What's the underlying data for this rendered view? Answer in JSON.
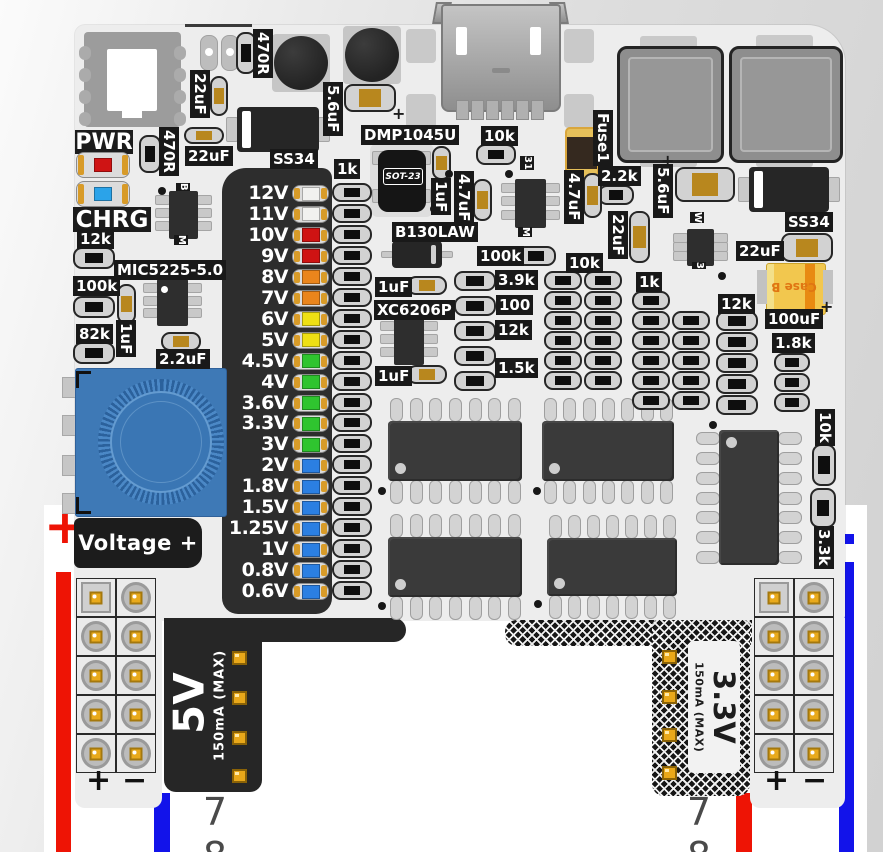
{
  "scene": "breadboard-power-supply-pcb-illustration",
  "breadboard": {
    "row_numbers_left": [
      "7",
      "8"
    ],
    "row_numbers_right": [
      "7",
      "8"
    ],
    "rail_plus": "+",
    "grid_plus": "+",
    "grid_minus": "−",
    "rail_red": "#ee1405",
    "rail_blue": "#1213ea"
  },
  "power_tabs": {
    "left": {
      "title": "5V",
      "subtitle": "150mA (MAX)"
    },
    "right": {
      "title": "3.3V",
      "subtitle": "150mA (MAX)"
    }
  },
  "voltage_selector": {
    "header_label": "Voltage +",
    "resistor_column_label": "1k",
    "rows": [
      {
        "label": "12V",
        "color": "#f1f1ef"
      },
      {
        "label": "11V",
        "color": "#f1f1ef"
      },
      {
        "label": "10V",
        "color": "#cf1313"
      },
      {
        "label": "9V",
        "color": "#cf1313"
      },
      {
        "label": "8V",
        "color": "#ea851c"
      },
      {
        "label": "7V",
        "color": "#ea851c"
      },
      {
        "label": "6V",
        "color": "#eee014"
      },
      {
        "label": "5V",
        "color": "#eee014"
      },
      {
        "label": "4.5V",
        "color": "#2fc42f"
      },
      {
        "label": "4V",
        "color": "#2fc42f"
      },
      {
        "label": "3.6V",
        "color": "#2fc42f"
      },
      {
        "label": "3.3V",
        "color": "#2fc42f"
      },
      {
        "label": "3V",
        "color": "#2fc42f"
      },
      {
        "label": "2V",
        "color": "#2b7fe2"
      },
      {
        "label": "1.8V",
        "color": "#2b7fe2"
      },
      {
        "label": "1.5V",
        "color": "#2b7fe2"
      },
      {
        "label": "1.25V",
        "color": "#2b7fe2"
      },
      {
        "label": "1V",
        "color": "#2b7fe2"
      },
      {
        "label": "0.8V",
        "color": "#2b7fe2"
      },
      {
        "label": "0.6V",
        "color": "#2b7fe2"
      }
    ]
  },
  "status_leds": {
    "pwr": {
      "label": "PWR",
      "color": "#cf1414"
    },
    "chrg": {
      "label": "CHRG",
      "color": "#2ba3e9"
    }
  },
  "chip_markings": {
    "dmp_package": "SOT-23",
    "tantalum_case": "Case B"
  },
  "silkscreen_labels": [
    {
      "text": "470R",
      "x": 253,
      "y": 29,
      "v": 1
    },
    {
      "text": "22uF",
      "x": 190,
      "y": 70,
      "v": 1
    },
    {
      "text": "5.6uF",
      "x": 323,
      "y": 82,
      "v": 1
    },
    {
      "text": "470R",
      "x": 159,
      "y": 127,
      "v": 1
    },
    {
      "text": "22uF",
      "x": 185,
      "y": 146
    },
    {
      "text": "SS34",
      "x": 270,
      "y": 149
    },
    {
      "text": "DMP1045U",
      "x": 361,
      "y": 125
    },
    {
      "text": "10k",
      "x": 481,
      "y": 126
    },
    {
      "text": "Fuse1",
      "x": 593,
      "y": 110,
      "v": 1
    },
    {
      "text": "2.2k",
      "x": 598,
      "y": 166
    },
    {
      "text": "1uF",
      "x": 431,
      "y": 178,
      "v": 1
    },
    {
      "text": "4.7uF",
      "x": 454,
      "y": 171,
      "v": 1
    },
    {
      "text": "4.7uF",
      "x": 564,
      "y": 170,
      "v": 1
    },
    {
      "text": "22uF",
      "x": 608,
      "y": 211,
      "v": 1
    },
    {
      "text": "5.6uF",
      "x": 653,
      "y": 164,
      "v": 1
    },
    {
      "text": "SS34",
      "x": 785,
      "y": 212
    },
    {
      "text": "22uF",
      "x": 736,
      "y": 241
    },
    {
      "text": "100uF",
      "x": 765,
      "y": 309
    },
    {
      "text": "1.8k",
      "x": 772,
      "y": 333
    },
    {
      "text": "12k",
      "x": 718,
      "y": 294
    },
    {
      "text": "1k",
      "x": 636,
      "y": 272
    },
    {
      "text": "10k",
      "x": 566,
      "y": 253
    },
    {
      "text": "100k",
      "x": 477,
      "y": 246
    },
    {
      "text": "3.9k",
      "x": 495,
      "y": 270
    },
    {
      "text": "100",
      "x": 496,
      "y": 295
    },
    {
      "text": "12k",
      "x": 495,
      "y": 320
    },
    {
      "text": "1.5k",
      "x": 495,
      "y": 358
    },
    {
      "text": "B130LAW",
      "x": 392,
      "y": 222
    },
    {
      "text": "1uF",
      "x": 375,
      "y": 277
    },
    {
      "text": "XC6206P",
      "x": 374,
      "y": 300
    },
    {
      "text": "1uF",
      "x": 375,
      "y": 366
    },
    {
      "text": "MIC5225-5.0",
      "x": 114,
      "y": 260
    },
    {
      "text": "12k",
      "x": 77,
      "y": 229
    },
    {
      "text": "100k",
      "x": 73,
      "y": 276
    },
    {
      "text": "82k",
      "x": 76,
      "y": 324
    },
    {
      "text": "1uF",
      "x": 116,
      "y": 320,
      "v": 1
    },
    {
      "text": "2.2uF",
      "x": 156,
      "y": 349
    },
    {
      "text": "1k",
      "x": 334,
      "y": 159
    },
    {
      "text": "10k",
      "x": 815,
      "y": 409,
      "v": 1
    },
    {
      "text": "3.3k",
      "x": 814,
      "y": 526,
      "v": 1
    },
    {
      "text": "B",
      "x": 176,
      "y": 183,
      "v": 1,
      "tiny": 1
    },
    {
      "text": "M",
      "x": 174,
      "y": 235,
      "v": 1,
      "tiny": 1
    },
    {
      "text": "31",
      "x": 520,
      "y": 156,
      "v": 1,
      "tiny": 1
    },
    {
      "text": "M",
      "x": 518,
      "y": 227,
      "v": 1,
      "tiny": 1
    },
    {
      "text": "W",
      "x": 690,
      "y": 212,
      "v": 1,
      "tiny": 1
    },
    {
      "text": "3",
      "x": 692,
      "y": 262,
      "v": 1,
      "tiny": 1
    }
  ],
  "resistors": [
    {
      "x": 236,
      "y": 32,
      "w": 20,
      "h": 42,
      "v": 1
    },
    {
      "x": 139,
      "y": 135,
      "w": 22,
      "h": 38,
      "v": 1
    },
    {
      "x": 476,
      "y": 144,
      "w": 40,
      "h": 21
    },
    {
      "x": 598,
      "y": 185,
      "w": 36,
      "h": 20
    },
    {
      "x": 516,
      "y": 246,
      "w": 40,
      "h": 20
    },
    {
      "x": 73,
      "y": 247,
      "w": 42,
      "h": 22
    },
    {
      "x": 73,
      "y": 296,
      "w": 42,
      "h": 22
    },
    {
      "x": 73,
      "y": 342,
      "w": 42,
      "h": 22
    },
    {
      "x": 812,
      "y": 444,
      "w": 24,
      "h": 42,
      "v": 1
    },
    {
      "x": 810,
      "y": 488,
      "w": 26,
      "h": 40,
      "v": 1
    }
  ],
  "resistor_banks": [
    {
      "x": 332,
      "y": 183,
      "sy": 20.95,
      "n": 20,
      "w": 40,
      "h": 19
    },
    {
      "x": 544,
      "y": 271,
      "sy": 20,
      "n": 6,
      "w": 38,
      "h": 19
    },
    {
      "x": 584,
      "y": 271,
      "sy": 20,
      "n": 6,
      "w": 38,
      "h": 19
    },
    {
      "x": 632,
      "y": 291,
      "sy": 20,
      "n": 6,
      "w": 38,
      "h": 19
    },
    {
      "x": 672,
      "y": 311,
      "sy": 20,
      "n": 5,
      "w": 38,
      "h": 19
    },
    {
      "x": 716,
      "y": 311,
      "sy": 21,
      "n": 5,
      "w": 42,
      "h": 20
    },
    {
      "x": 774,
      "y": 353,
      "sy": 20,
      "n": 3,
      "w": 36,
      "h": 19
    },
    {
      "x": 454,
      "y": 271,
      "sy": 25,
      "n": 3,
      "w": 42,
      "h": 20
    },
    {
      "x": 454,
      "y": 346,
      "sy": 25,
      "n": 2,
      "w": 42,
      "h": 20
    }
  ],
  "capacitors": [
    {
      "x": 210,
      "y": 76,
      "w": 18,
      "h": 40,
      "v": 1
    },
    {
      "x": 344,
      "y": 84,
      "w": 52,
      "h": 28
    },
    {
      "x": 184,
      "y": 127,
      "w": 40,
      "h": 17
    },
    {
      "x": 117,
      "y": 284,
      "w": 19,
      "h": 40,
      "v": 1
    },
    {
      "x": 161,
      "y": 332,
      "w": 40,
      "h": 19
    },
    {
      "x": 432,
      "y": 146,
      "w": 19,
      "h": 34,
      "v": 1
    },
    {
      "x": 473,
      "y": 179,
      "w": 19,
      "h": 42,
      "v": 1
    },
    {
      "x": 583,
      "y": 173,
      "w": 19,
      "h": 45,
      "v": 1
    },
    {
      "x": 629,
      "y": 211,
      "w": 21,
      "h": 52,
      "v": 1
    },
    {
      "x": 675,
      "y": 167,
      "w": 60,
      "h": 35
    },
    {
      "x": 781,
      "y": 233,
      "w": 52,
      "h": 29
    },
    {
      "x": 407,
      "y": 276,
      "w": 40,
      "h": 19
    },
    {
      "x": 407,
      "y": 365,
      "w": 40,
      "h": 19
    }
  ],
  "diodes": [
    {
      "x": 237,
      "y": 107,
      "w": 82,
      "h": 45,
      "stripe": "left"
    },
    {
      "x": 749,
      "y": 167,
      "w": 80,
      "h": 45,
      "stripe": "left"
    },
    {
      "x": 392,
      "y": 241,
      "w": 50,
      "h": 27,
      "stripe": "right"
    }
  ],
  "electrolytics": [
    {
      "cx": 301,
      "cy": 63,
      "r": 27
    },
    {
      "cx": 372,
      "cy": 55,
      "r": 27
    }
  ],
  "big_caps": [
    {
      "x": 617,
      "y": 46,
      "w": 101,
      "h": 111
    },
    {
      "x": 729,
      "y": 46,
      "w": 108,
      "h": 111
    }
  ],
  "soic_chips": [
    {
      "x": 388,
      "y": 421,
      "w": 134,
      "h": 60,
      "dir": "h"
    },
    {
      "x": 542,
      "y": 421,
      "w": 132,
      "h": 60,
      "dir": "h"
    },
    {
      "x": 388,
      "y": 537,
      "w": 134,
      "h": 60,
      "dir": "h"
    },
    {
      "x": 547,
      "y": 538,
      "w": 130,
      "h": 58,
      "dir": "h"
    },
    {
      "x": 719,
      "y": 430,
      "w": 60,
      "h": 135,
      "dir": "v"
    }
  ],
  "sot_chips": [
    {
      "x": 169,
      "y": 191,
      "w": 29,
      "h": 48
    },
    {
      "x": 515,
      "y": 179,
      "w": 31,
      "h": 49
    },
    {
      "x": 687,
      "y": 229,
      "w": 27,
      "h": 37
    },
    {
      "x": 157,
      "y": 279,
      "w": 31,
      "h": 47
    },
    {
      "x": 394,
      "y": 317,
      "w": 30,
      "h": 48
    }
  ],
  "vias": [
    [
      158,
      187
    ],
    [
      430,
      205
    ],
    [
      445,
      170
    ],
    [
      505,
      170
    ],
    [
      718,
      272
    ],
    [
      378,
      487
    ],
    [
      533,
      487
    ],
    [
      378,
      602
    ],
    [
      534,
      600
    ],
    [
      709,
      421
    ]
  ],
  "plus_marks": [
    [
      392,
      104
    ],
    [
      661,
      151
    ],
    [
      820,
      297
    ]
  ]
}
